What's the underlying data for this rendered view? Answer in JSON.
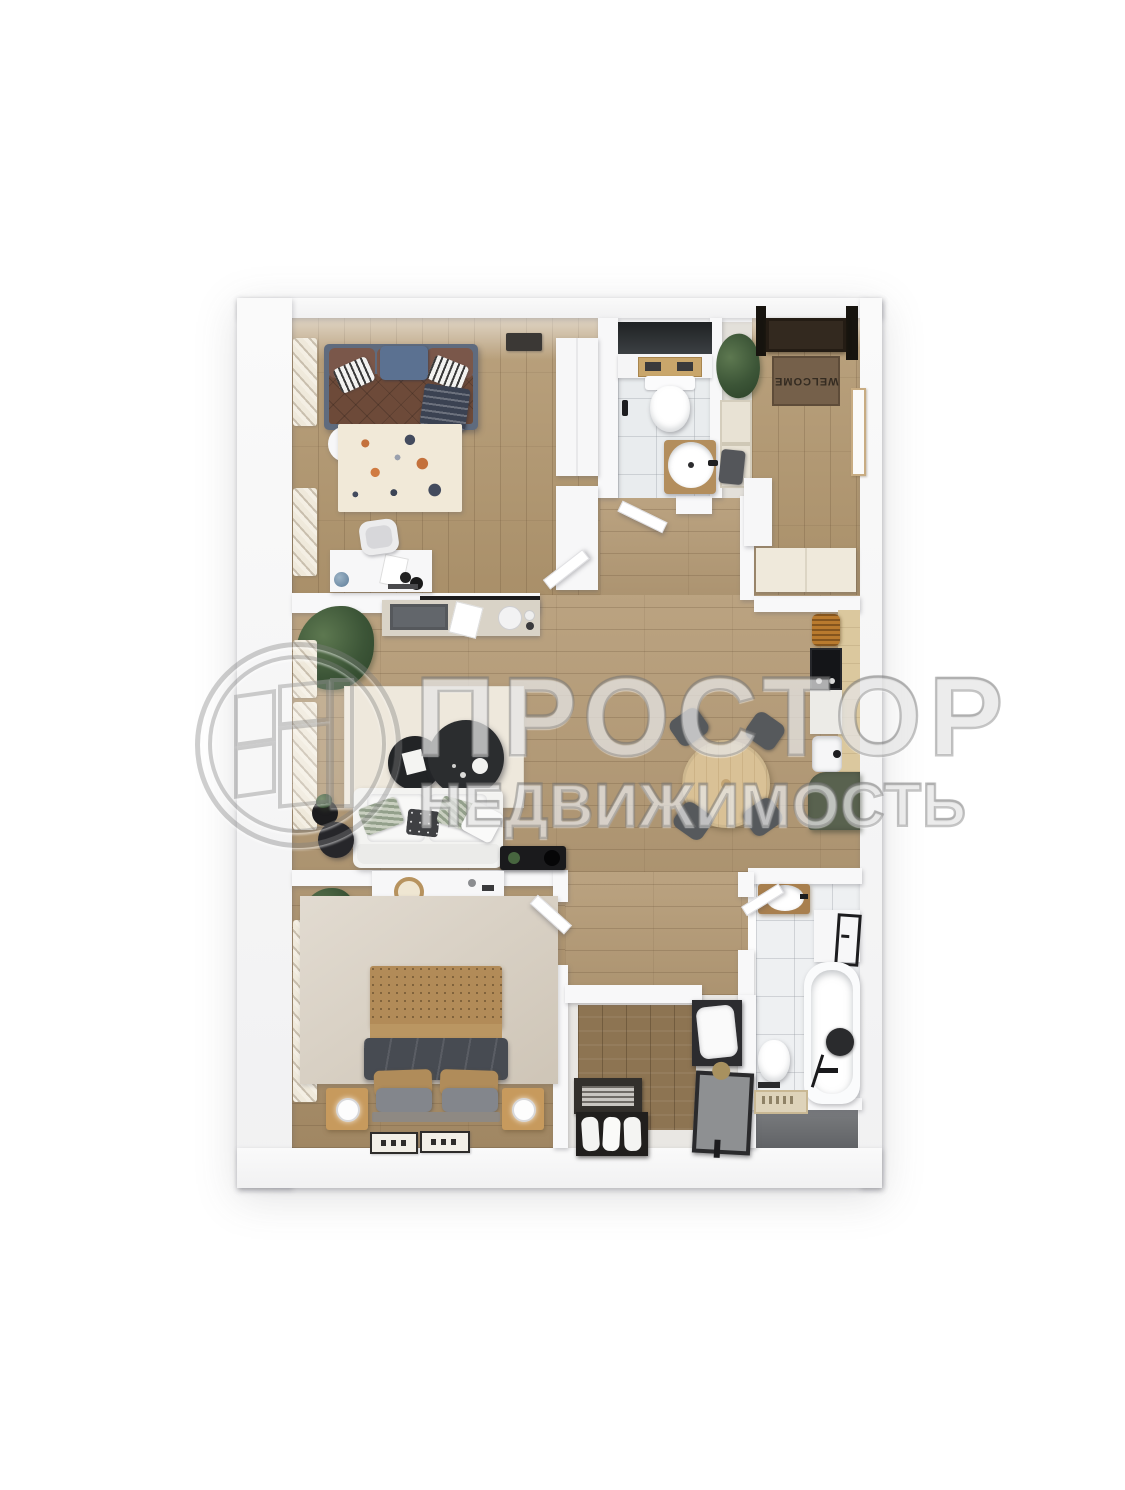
{
  "watermark": {
    "logo": "prostor-circle-window-logo",
    "title": "ПРОСТОР",
    "subtitle": "НЕДВИЖИМОСТЬ"
  },
  "entry": {
    "doormat_text": "WELCOME"
  },
  "palette": {
    "background": "#ffffff",
    "wall": "#f8f8f9",
    "floor_wood": "#b59b76",
    "floor_wood_dark": "#a98e68",
    "tile": "#e9ecee",
    "kitchen_green": "#59624f",
    "counter_wood": "#dbc89e",
    "sofa_bed_brown": "#6d4a39",
    "accent_blue_pillow": "#5b7191",
    "doormat_brown": "#75604a",
    "front_door": "#33291f",
    "rug_cream": "#eee8dc",
    "rug_beige": "#d8cfc1",
    "duvet_gray": "#474b52",
    "headboard_tan": "#b28b58",
    "watermark_gray": "#7a7a7a"
  },
  "plan": {
    "rooms": [
      {
        "id": "bedroom-top-left",
        "floor": "wood",
        "furniture": [
          "window-curtain",
          "sofa-bed",
          "blue-pillow",
          "striped-pillows",
          "throw-blanket",
          "patterned-rug",
          "round-side-table",
          "wall-art",
          "wardrobe",
          "tall-cabinet",
          "desk",
          "desk-chair",
          "globe",
          "interior-door"
        ]
      },
      {
        "id": "wc",
        "floor": "tile",
        "furniture": [
          "dark-wall-panel",
          "cistern-shelf",
          "tray",
          "wall-hung-toilet",
          "round-basin",
          "basin-cabinet",
          "interior-door"
        ]
      },
      {
        "id": "entry-hall",
        "floor": "wood",
        "furniture": [
          "entrance-door",
          "welcome-mat",
          "wall-frame",
          "plant",
          "niche-cabinet",
          "stool",
          "white-cabinet",
          "storage-bench"
        ]
      },
      {
        "id": "living-room",
        "floor": "wood",
        "furniture": [
          "plant",
          "window-curtain",
          "console-table",
          "laptop",
          "paper-sheet",
          "kettle",
          "cream-rug",
          "coffee-table-small",
          "coffee-table-large",
          "white-sofa",
          "sofa-pillows",
          "black-side-tables",
          "media-console"
        ]
      },
      {
        "id": "kitchen-dining",
        "floor": "wood",
        "furniture": [
          "upper-cabinet",
          "counter",
          "bread-basket",
          "cooktop",
          "sink",
          "green-base-cabinet",
          "round-dining-table",
          "dining-chairs"
        ]
      },
      {
        "id": "bedroom-bottom-left",
        "floor": "wood",
        "furniture": [
          "plant",
          "window-curtain",
          "dresser",
          "woven-wall-decor",
          "beige-rug",
          "double-bed",
          "woven-headboard",
          "gray-duvet",
          "pillows",
          "nightstand-left",
          "nightstand-right",
          "table-lamps",
          "runner-rugs",
          "interior-door"
        ]
      },
      {
        "id": "storage-room",
        "floor": "wood-panel",
        "furniture": [
          "magazine-rack",
          "towel-box",
          "shelf-unit",
          "pillow",
          "laundry-basket"
        ]
      },
      {
        "id": "bathroom",
        "floor": "tile",
        "furniture": [
          "vanity-basin",
          "wall-cabinet",
          "towel-rail",
          "bathtub",
          "shower-head",
          "toilet",
          "bath-mat",
          "interior-door"
        ]
      }
    ]
  }
}
